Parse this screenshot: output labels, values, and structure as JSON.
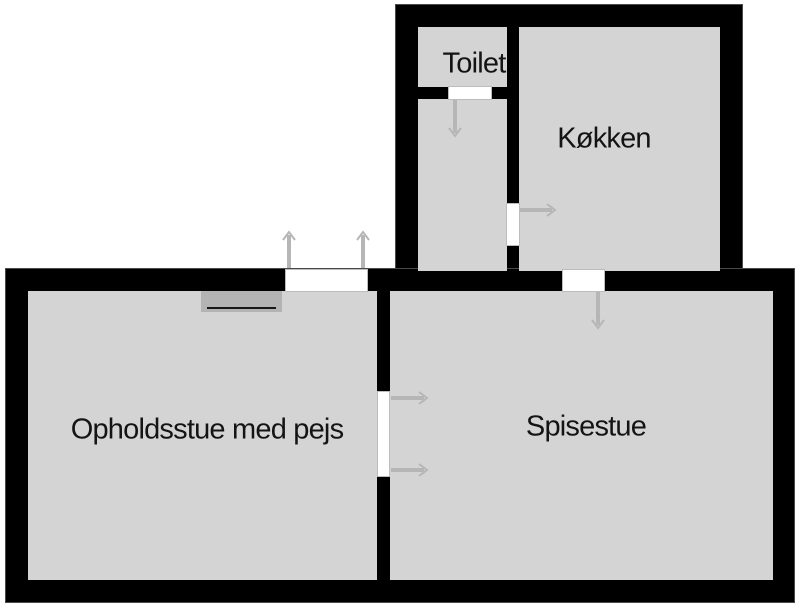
{
  "plan": {
    "title": "Floor plan",
    "rooms": [
      {
        "id": "toilet",
        "label": "Toilet"
      },
      {
        "id": "kokken",
        "label": "Køkken"
      },
      {
        "id": "opholdsstue",
        "label": "Opholdsstue med pejs"
      },
      {
        "id": "spisestue",
        "label": "Spisestue"
      },
      {
        "id": "gang",
        "label": ""
      }
    ],
    "doors": [
      {
        "name": "toilet-door",
        "type": "single",
        "swing_direction": "down"
      },
      {
        "name": "hall-to-kitchen-door",
        "type": "single",
        "swing_direction": "right"
      },
      {
        "name": "kitchen-to-dining-door",
        "type": "single",
        "swing_direction": "down"
      },
      {
        "name": "living-room-exterior-door",
        "type": "double",
        "swing_direction": "up"
      },
      {
        "name": "living-to-dining-double-door",
        "type": "double",
        "swing_direction": "right"
      }
    ],
    "fireplace": {
      "present": true,
      "room_label": "Opholdsstue med pejs"
    },
    "colors": {
      "wall": "#000000",
      "wall_outline": "#4a4a4a",
      "floor": "#d4d4d4",
      "door_opening": "#ffffff",
      "door_swing": "#b6b6b6",
      "fireplace": "#b3b3b3",
      "fireplace_line": "#161616",
      "label_text": "#141414",
      "background": "#ffffff"
    }
  }
}
